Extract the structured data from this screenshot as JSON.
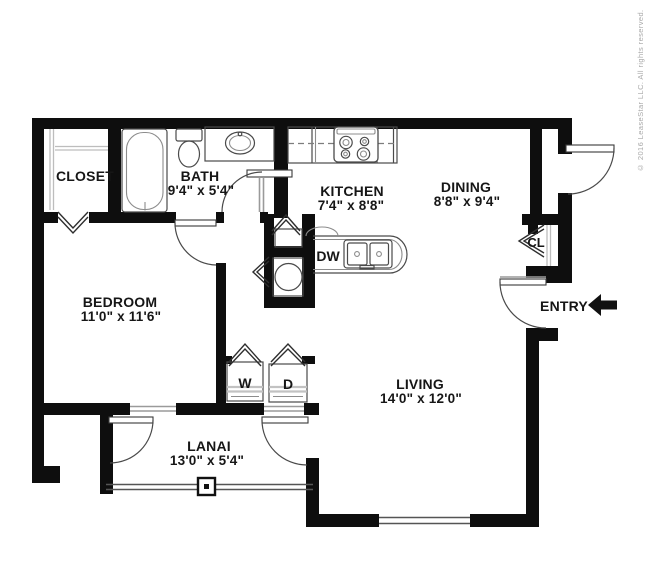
{
  "floorplan": {
    "rooms": {
      "closet": {
        "label": "CLOSET"
      },
      "bath": {
        "label": "BATH",
        "dims": "9'4\" x 5'4\""
      },
      "kitchen": {
        "label": "KITCHEN",
        "dims": "7'4\" x 8'8\""
      },
      "dining": {
        "label": "DINING",
        "dims": "8'8\" x 9'4\""
      },
      "bedroom": {
        "label": "BEDROOM",
        "dims": "11'0\" x 11'6\""
      },
      "living": {
        "label": "LIVING",
        "dims": "14'0\" x 12'0\""
      },
      "lanai": {
        "label": "LANAI",
        "dims": "13'0\" x 5'4\""
      },
      "entry_closet": {
        "label": "CL"
      }
    },
    "markers": {
      "entry": {
        "label": "ENTRY"
      }
    },
    "appliances": {
      "washer": {
        "label": "W"
      },
      "dryer": {
        "label": "D"
      },
      "dishwasher": {
        "label": "DW"
      }
    },
    "colors": {
      "wall": "#0e0e0e",
      "fixture": "#4a4a4a",
      "header_line": "#9a9a9a",
      "text": "#161616",
      "copyright": "#a9a9a9"
    },
    "copyright": "© 2016 LeaseStar LLC. All rights reserved."
  }
}
